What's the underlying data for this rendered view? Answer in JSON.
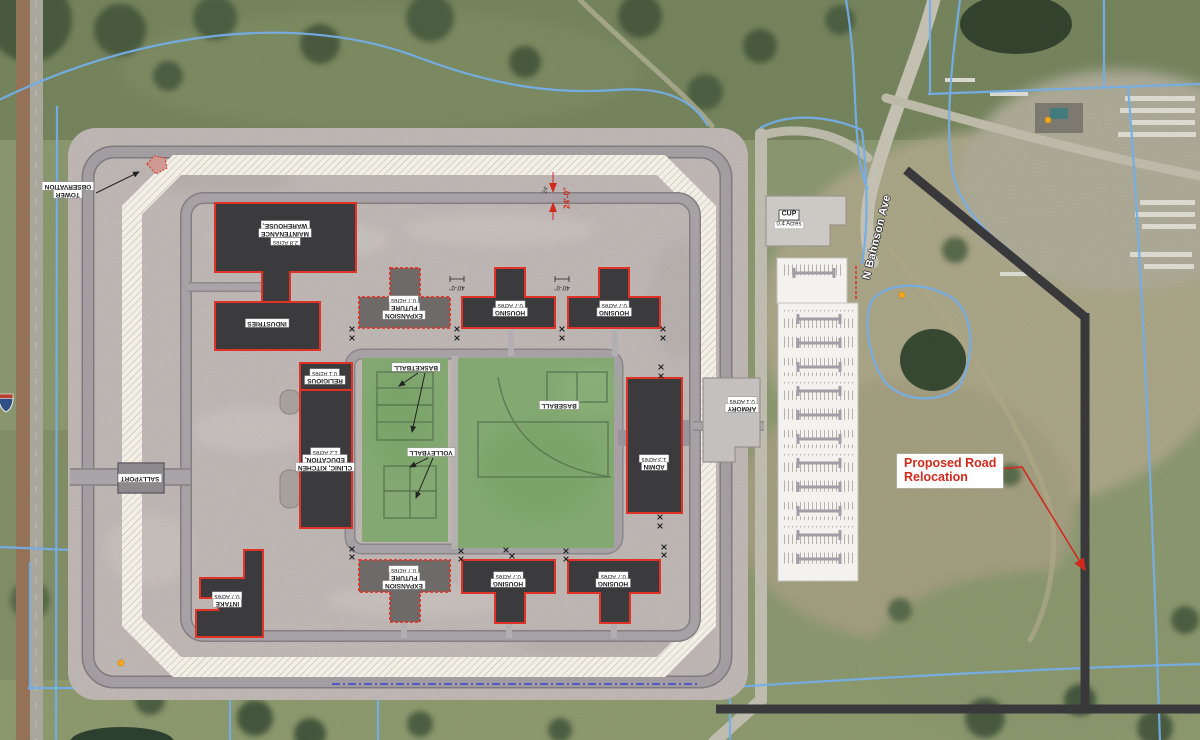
{
  "colors": {
    "building_fill": "#3b3a3c",
    "building_outline": "#e03227",
    "future_building_fill": "#6e6a67",
    "field_green": "#83a872",
    "annotation_red": "#d2291d",
    "parcel_line_blue": "#74aee8",
    "proposed_road_gray": "#39393c",
    "hatch_band": "#f2f0e6"
  },
  "labels": {
    "observation_tower": {
      "line1": "OBSERVATION",
      "line2": "TOWER"
    },
    "warehouse": {
      "line1": "WAREHOUSE,",
      "line2": "MAINTENANCE",
      "acres": "2.8 Acres"
    },
    "industries": {
      "name": "INDUSTRIES"
    },
    "future_expansion_north": {
      "acres": "0.7 Acres",
      "line1": "FUTURE",
      "line2": "EXPANSION"
    },
    "housing_north_1": {
      "acres": "0.7 Acres",
      "name": "HOUSING"
    },
    "housing_north_2": {
      "acres": "0.7 Acres",
      "name": "HOUSING"
    },
    "basketball": {
      "name": "BASKETBALL"
    },
    "volleyball": {
      "name": "VOLLEYBALL"
    },
    "baseball": {
      "name": "BASEBALL"
    },
    "religious": {
      "acres": "0.1 Acres",
      "name": "RELIGIOUS"
    },
    "education": {
      "acres": "1.2 Acres",
      "line1": "EDUCATION,",
      "line2": "CLINIC, KITCHEN"
    },
    "admin": {
      "acres": "1.3 Acres",
      "name": "ADMIN"
    },
    "armory": {
      "acres": "0.1 Acres",
      "name": "ARMORY"
    },
    "sallyport": {
      "name": "SALLYPORT"
    },
    "intake": {
      "acres": "0.7 Acres",
      "name": "INTAKE"
    },
    "future_expansion_south": {
      "acres": "0.7 Acres",
      "line1": "FUTURE",
      "line2": "EXPANSION"
    },
    "housing_south_1": {
      "acres": "0.7 Acres",
      "name": "HOUSING"
    },
    "housing_south_2": {
      "acres": "0.7 Acres",
      "name": "HOUSING"
    },
    "cup": {
      "name": "CUP",
      "acres": "0.4 Acres"
    }
  },
  "annotations": {
    "proposed_road_line1": "Proposed Road",
    "proposed_road_line2": "Relocation",
    "street_name": "N Bahnson Ave",
    "road_width_dim": "24'-0\"",
    "road_width_dim_small": "24'",
    "building_gap_dim_left": "40'-0\"",
    "building_gap_dim_right": "40'-0\""
  }
}
